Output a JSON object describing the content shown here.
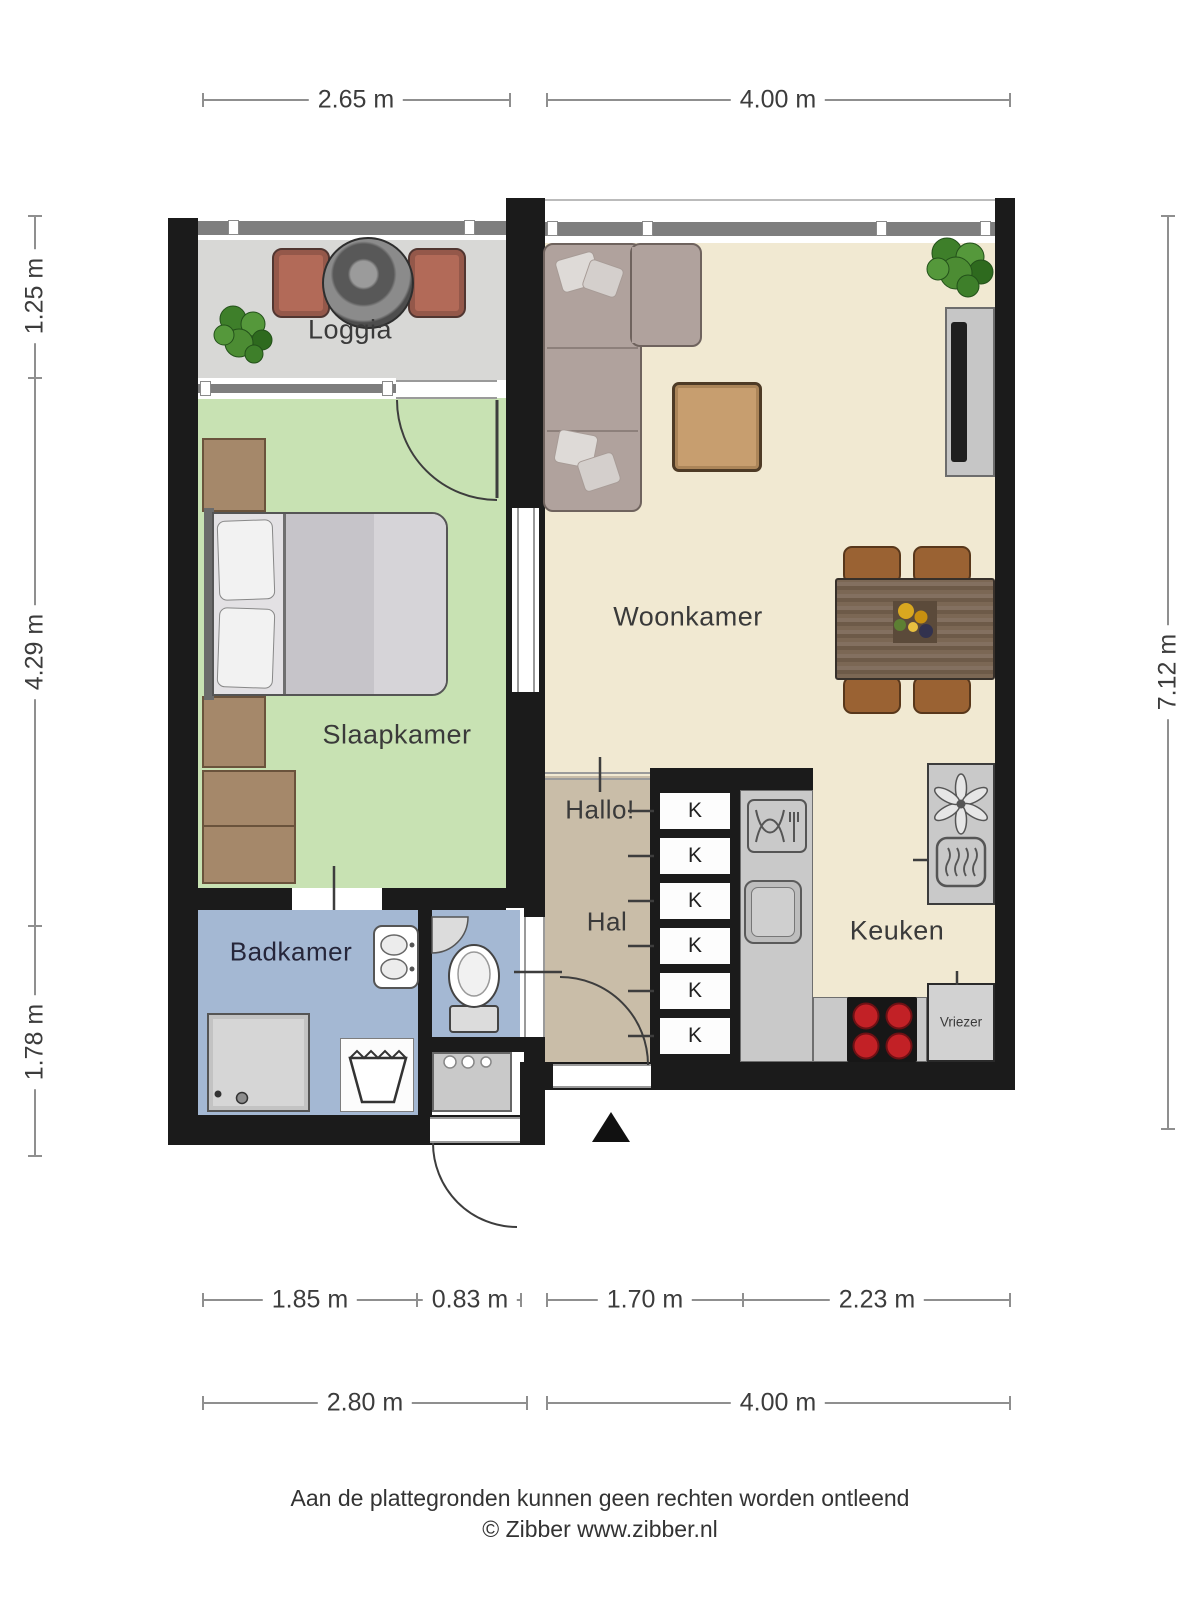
{
  "rooms": {
    "loggia": "Loggia",
    "woonkamer": "Woonkamer",
    "slaapkamer": "Slaapkamer",
    "badkamer": "Badkamer",
    "hal": "Hal",
    "hallo": "Hallo!",
    "keuken": "Keuken",
    "vriezer": "Vriezer",
    "kast": "K"
  },
  "dimensions": {
    "top": [
      "2.65 m",
      "4.00 m"
    ],
    "left": [
      "1.25 m",
      "4.29 m",
      "1.78 m"
    ],
    "right": [
      "7.12 m"
    ],
    "bottom_inner": [
      "1.85 m",
      "0.83 m",
      "1.70 m",
      "2.23 m"
    ],
    "bottom_outer": [
      "2.80 m",
      "4.00 m"
    ]
  },
  "footer": {
    "disclaimer": "Aan de plattegronden kunnen geen rechten worden ontleend",
    "copyright": "© Zibber www.zibber.nl"
  },
  "colors": {
    "wall": "#1b1b1b",
    "loggia_floor": "#d8d8d6",
    "bedroom_floor": "#c8e2b3",
    "living_floor": "#f1e9d2",
    "hall_floor": "#c9bda8",
    "bath_floor": "#a4b8d3",
    "counter": "#c9c9c9",
    "burner_red": "#c22126"
  }
}
